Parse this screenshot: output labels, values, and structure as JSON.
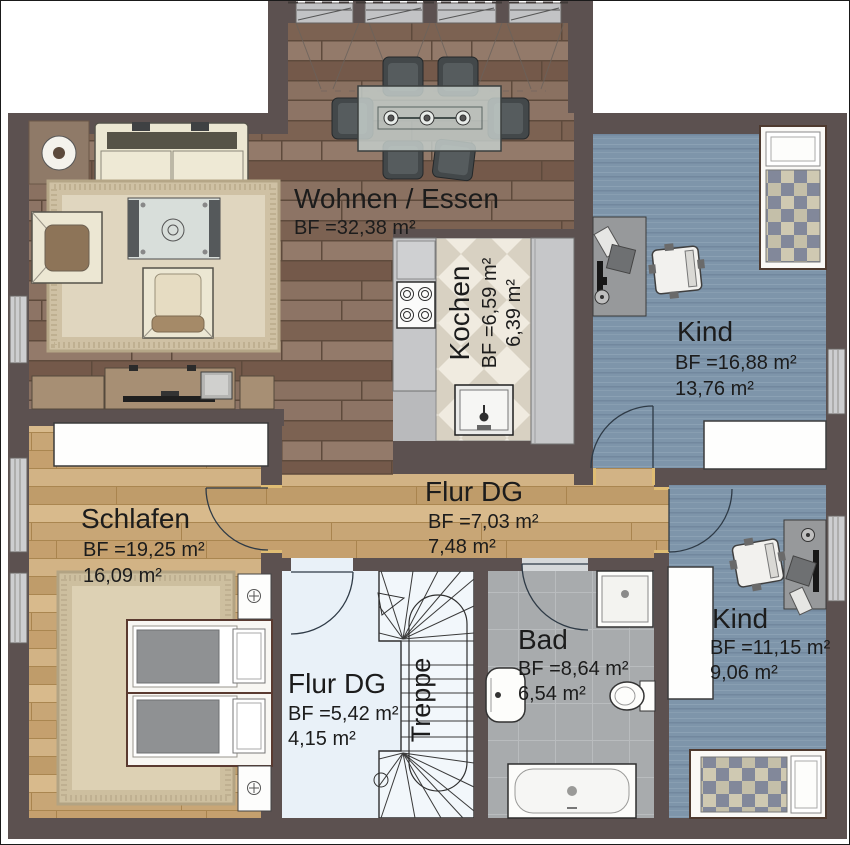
{
  "plan": {
    "rooms": {
      "wohnen_essen": {
        "name": "Wohnen / Essen",
        "area_bf": "BF =32,38 m²"
      },
      "kochen": {
        "name": "Kochen",
        "area_bf": "BF =6,59 m²",
        "area_living": "6,39 m²"
      },
      "kind_gross": {
        "name": "Kind",
        "area_bf": "BF =16,88 m²",
        "area_living": "13,76 m²"
      },
      "schlafen": {
        "name": "Schlafen",
        "area_bf": "BF =19,25 m²",
        "area_living": "16,09 m²"
      },
      "flur_mitte": {
        "name": "Flur DG",
        "area_bf": "BF =7,03 m²",
        "area_living": "7,48 m²"
      },
      "flur_unten": {
        "name": "Flur DG",
        "area_bf": "BF =5,42 m²",
        "area_living": "4,15 m²"
      },
      "treppe": {
        "name": "Treppe"
      },
      "bad": {
        "name": "Bad",
        "area_bf": "BF =8,64 m²",
        "area_living": "6,54 m²"
      },
      "kind_klein": {
        "name": "Kind",
        "area_bf": "BF =11,15 m²",
        "area_living": "9,06 m²"
      }
    },
    "colors": {
      "wall": "#5c5150",
      "floor_parquet_dark": "#866c5c",
      "floor_parquet_light": "#cbaa7c",
      "floor_blue": "#7e95aa",
      "floor_tile_bath": "#a8abad",
      "floor_tile_kitchen_light": "#f0ebe0",
      "floor_tile_kitchen_dark": "#d8d1c2",
      "floor_hall_pale": "#e9f1f8",
      "window": "#cdced0",
      "label_text": "#1c1c1c"
    }
  }
}
